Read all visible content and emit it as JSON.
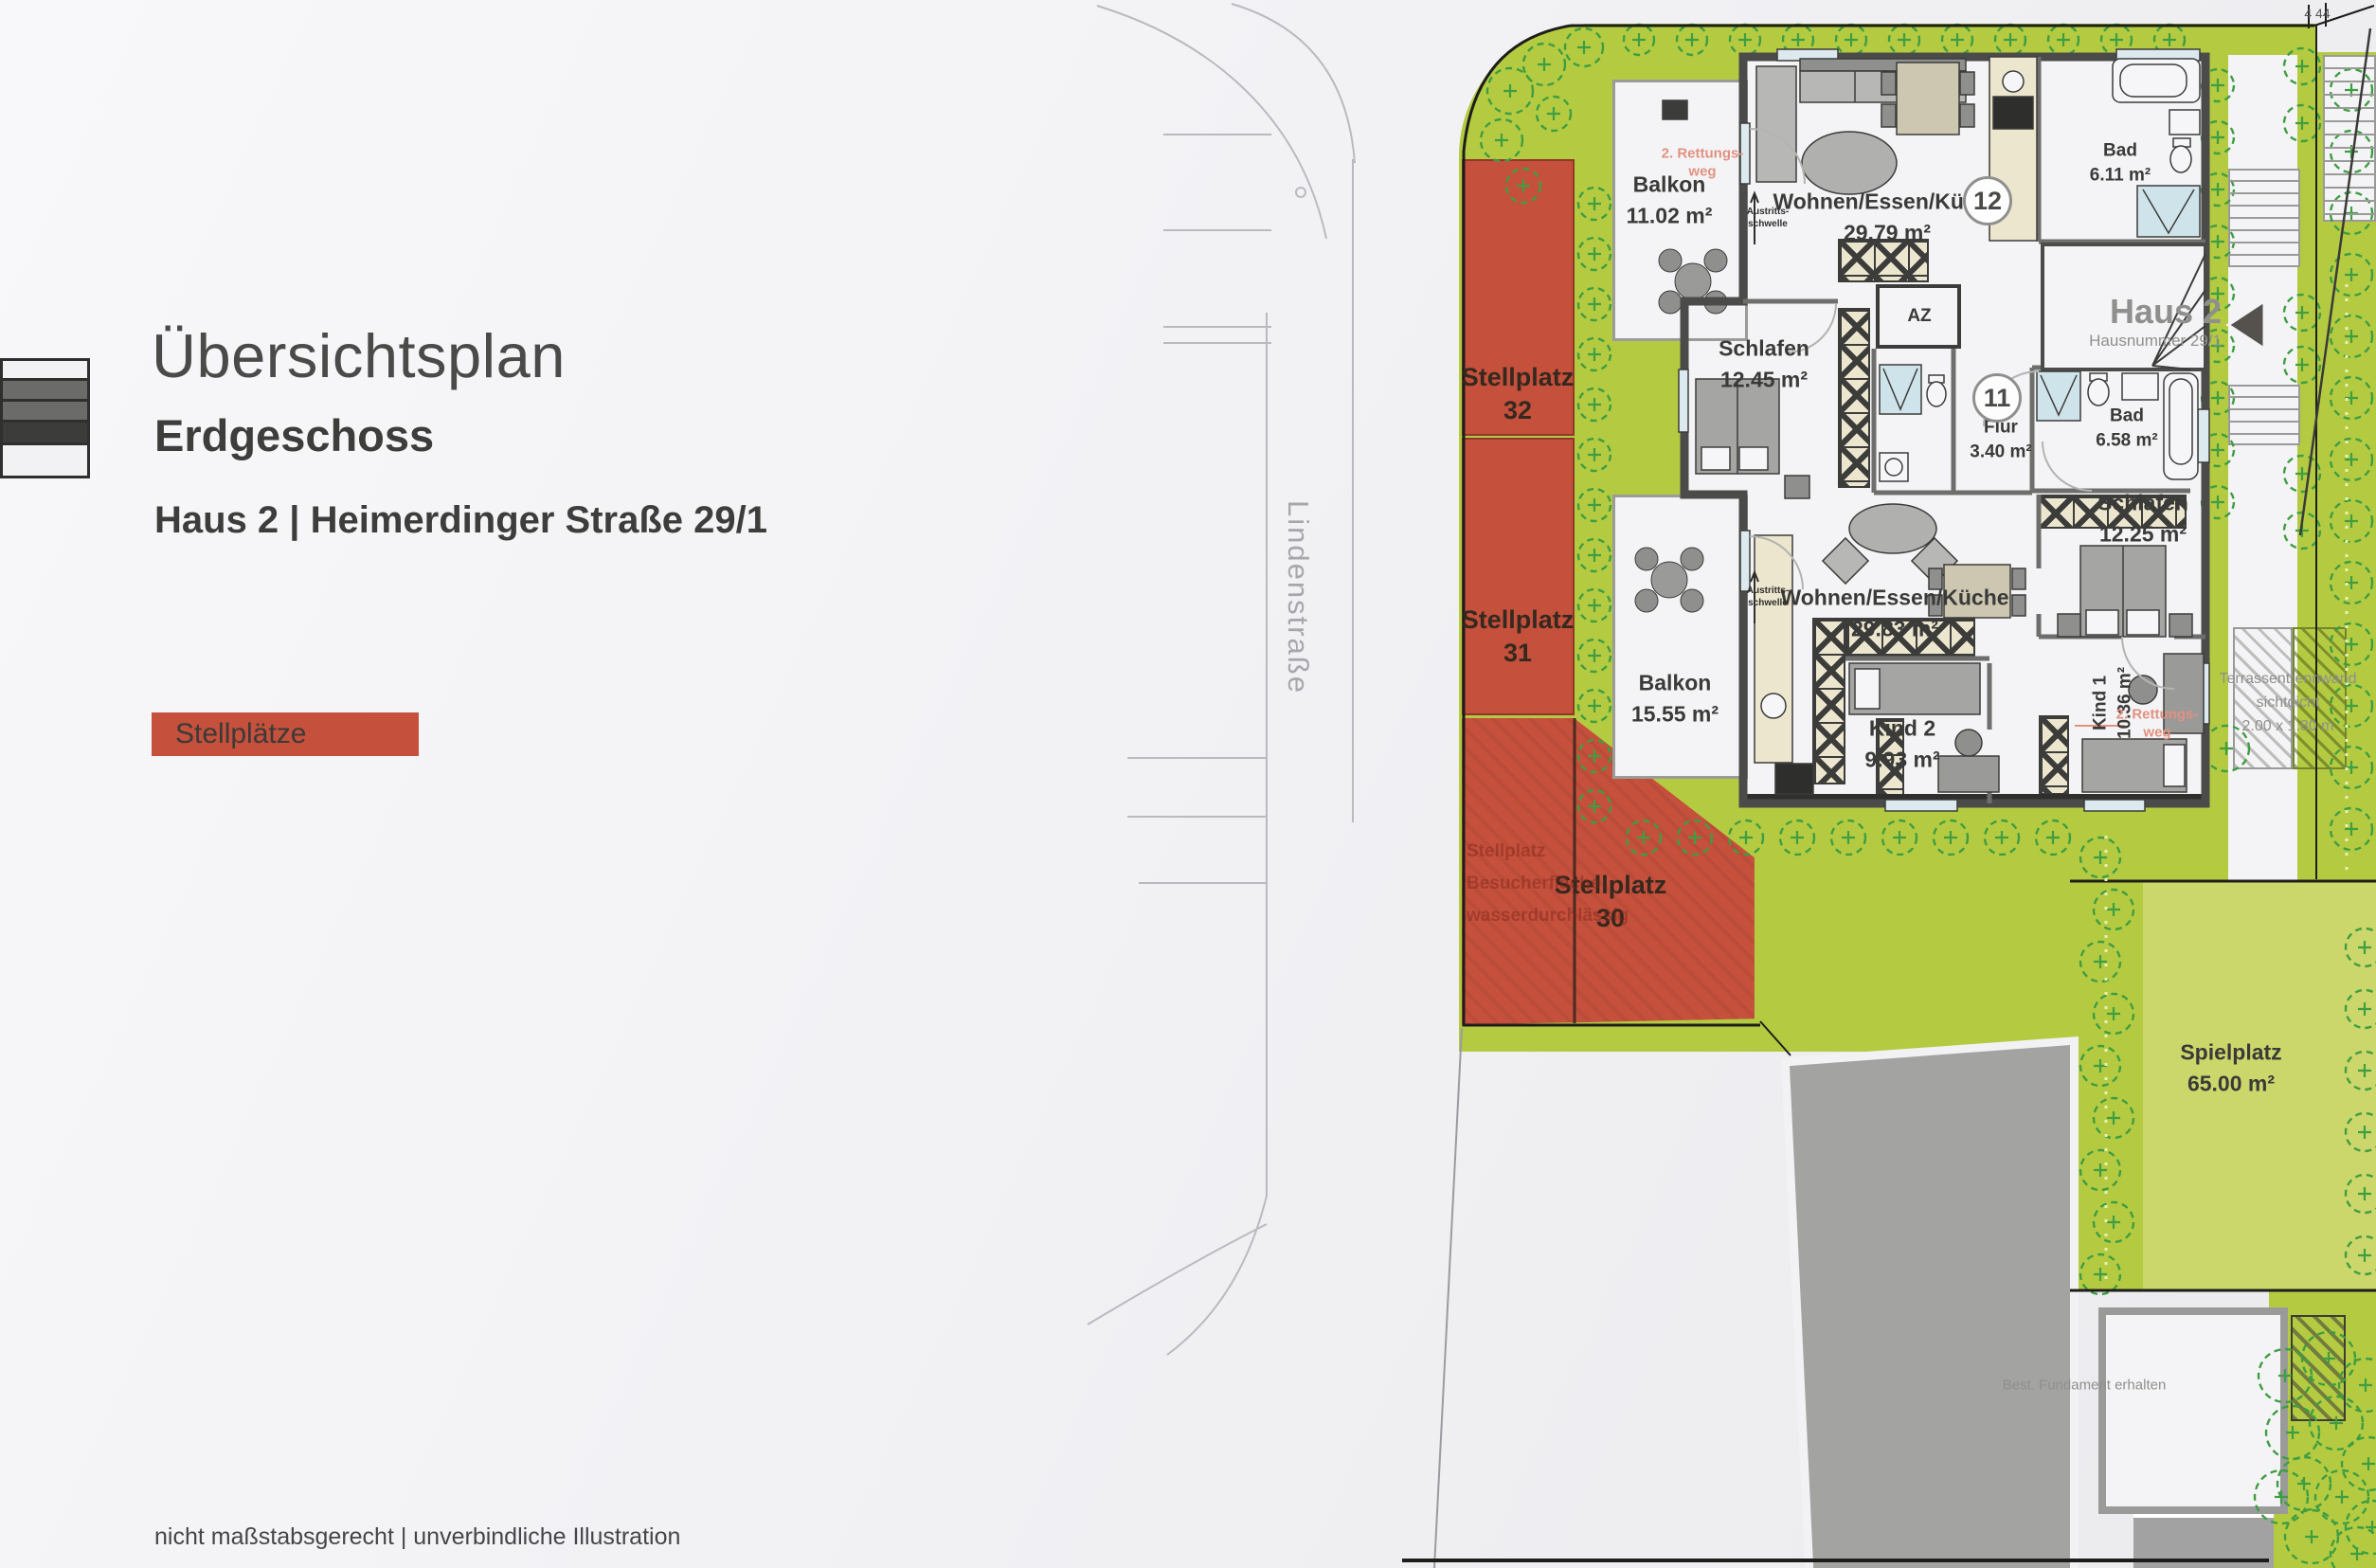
{
  "header": {
    "title": "Übersichtsplan",
    "subtitle": "Erdgeschoss",
    "address": "Haus 2 | Heimerdinger Straße 29/1",
    "legend_label": "Stellplätze"
  },
  "footer": {
    "disclaimer": "nicht maßstabsgerecht | unverbindliche Illustration"
  },
  "street": {
    "name": "Lindenstraße"
  },
  "site": {
    "parking": [
      {
        "label": "Stellplatz",
        "number": "32"
      },
      {
        "label": "Stellplatz",
        "number": "31"
      },
      {
        "label": "Stellplatz",
        "number": "30"
      }
    ],
    "parking_note": [
      "Stellplatz",
      "Besucherfläche",
      "wasserdurchlässig"
    ],
    "playground": {
      "name": "Spielplatz",
      "area": "65.00 m²"
    },
    "terrace_divider": [
      "Terrassentrennwand",
      "sichtdicht",
      "2.00 x 1.80 m"
    ],
    "foundation_note": "Best. Fundament erhalten",
    "survey_mark": "4 44"
  },
  "building": {
    "house_label": "Haus 2",
    "house_sublabel": "Hausnummer 29/1",
    "units": [
      {
        "badge": "12"
      },
      {
        "badge": "11"
      }
    ],
    "rooms": {
      "balkon12": {
        "name": "Balkon",
        "area": "11.02 m²"
      },
      "wohnen12": {
        "name": "Wohnen/Essen/Küche",
        "area": "29.79 m²"
      },
      "bad12": {
        "name": "Bad",
        "area": "6.11 m²"
      },
      "schlafen12a": {
        "name": "Schlafen",
        "area": "12.45 m²"
      },
      "az": {
        "name": "AZ"
      },
      "flur": {
        "name": "Flur",
        "area": "3.40 m²"
      },
      "bad11": {
        "name": "Bad",
        "area": "6.58 m²"
      },
      "schlafen12b": {
        "name": "Schlafen",
        "area": "12.25 m²"
      },
      "wohnen11": {
        "name": "Wohnen/Essen/Küche",
        "area": "29.83 m²"
      },
      "balkon11": {
        "name": "Balkon",
        "area": "15.55 m²"
      },
      "kind2": {
        "name": "Kind 2",
        "area": "9.93 m²"
      },
      "kind1": {
        "name": "Kind 1",
        "area": "10.36 m²"
      }
    },
    "annotations": {
      "rettungsweg": {
        "line1": "2. Rettungs-",
        "line2": "weg"
      },
      "austritt": {
        "line1": "Austritts-",
        "line2": "schwelle"
      }
    }
  },
  "colors": {
    "accent_red": "#c5503c",
    "green_bright": "#b4cb41",
    "green_light": "#cbd76a",
    "wall": "#4b4b49"
  }
}
